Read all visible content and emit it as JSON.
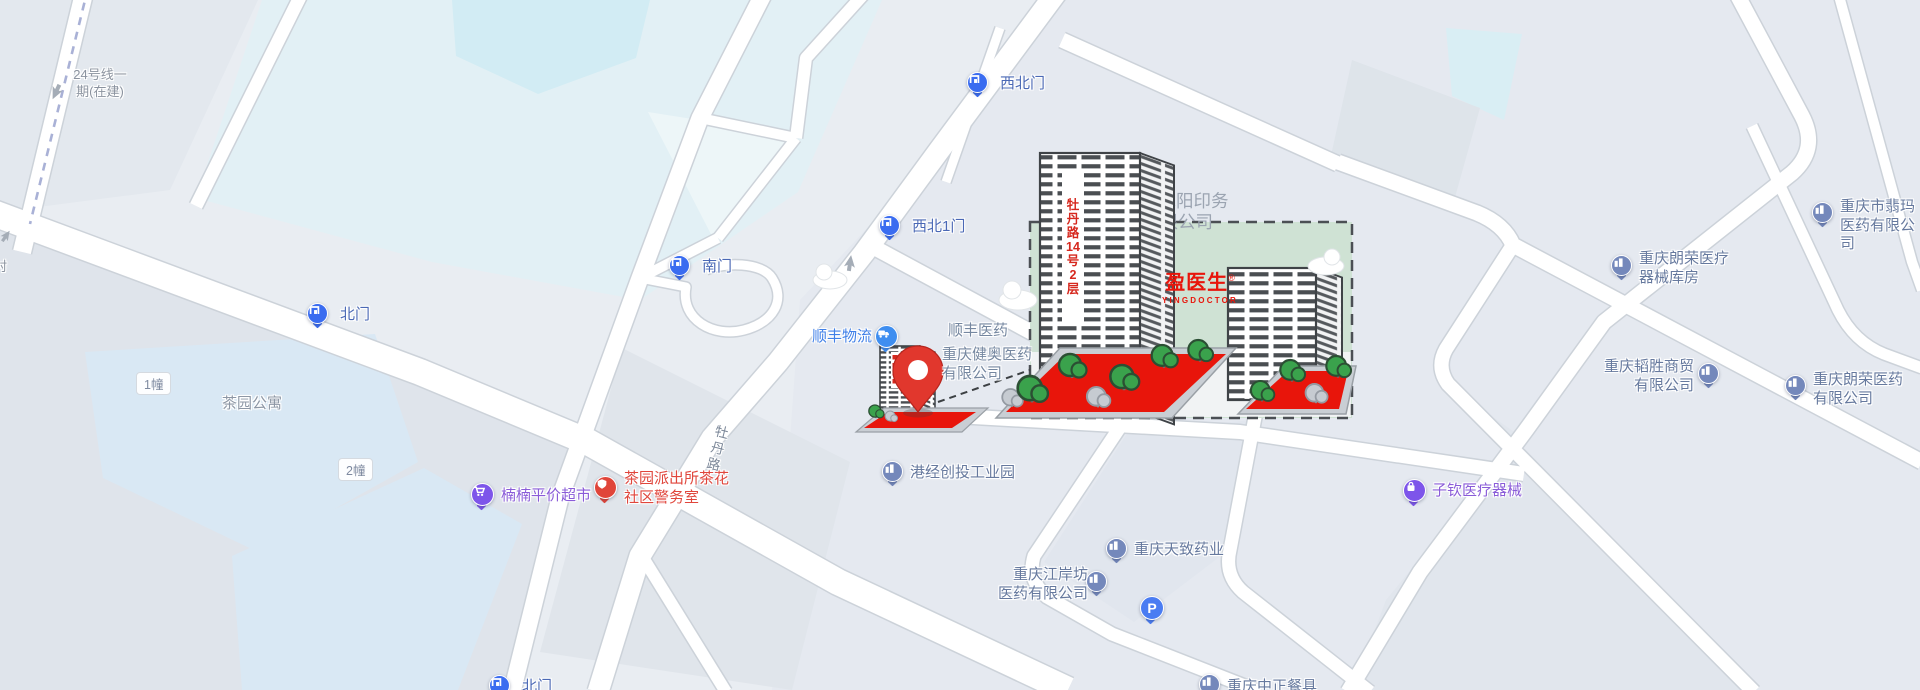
{
  "transit": {
    "line_label": "24号线一\n期(在建)"
  },
  "roads": {
    "mudan_label": "牡丹路",
    "partial_label": "村"
  },
  "residential": {
    "name": "茶园公寓",
    "badge1": "1幢",
    "badge2": "2幢"
  },
  "gates": {
    "north": "北门",
    "south": "南门",
    "northwest": "西北门",
    "northwest1": "西北1门",
    "north_bottom": "北门"
  },
  "pois": {
    "supermarket": "楠楠平价超市",
    "police_station": "茶园派出所茶花\n社区警务室",
    "sf_logistics": "顺丰物流",
    "sf_pharma": "顺丰医药",
    "jianao_pharma": "重庆健奥医药\n有限公司",
    "industrial_park": "港经创投工业园",
    "tianzhi_pharma": "重庆天致药业",
    "jianganfang_pharma": "重庆江岸坊\n医药有限公司",
    "zhongzheng": "重庆中正餐具",
    "ziqin_medical": "子钦医疗器械",
    "langrong_warehouse": "重庆朗荣医疗\n器械库房",
    "taosheng_trade": "重庆韬胜商贸\n有限公司",
    "langrong_pharma": "重庆朗荣医药\n有限公司",
    "feima_pharma": "重庆市翡玛\n医药有限公司",
    "parking": "P"
  },
  "highlight": {
    "company_line1": "重庆旭阳印务",
    "company_line2": "有限公司",
    "building_sign": "牡\n丹\n路\n14\n号\n2\n层",
    "brand": "盈医生",
    "brand_reg": "®",
    "brand_en": "YINGDOCTOR"
  },
  "colors": {
    "accent_red": "#e1372d",
    "highlight_green": "#cfe2d4",
    "gate_blue": "#3a6cf0",
    "poi_slate": "#7488bb",
    "purple": "#7d55ea",
    "police_red": "#e0453a",
    "sf_blue": "#3f8ef0",
    "parking_blue": "#4a7cf2"
  }
}
